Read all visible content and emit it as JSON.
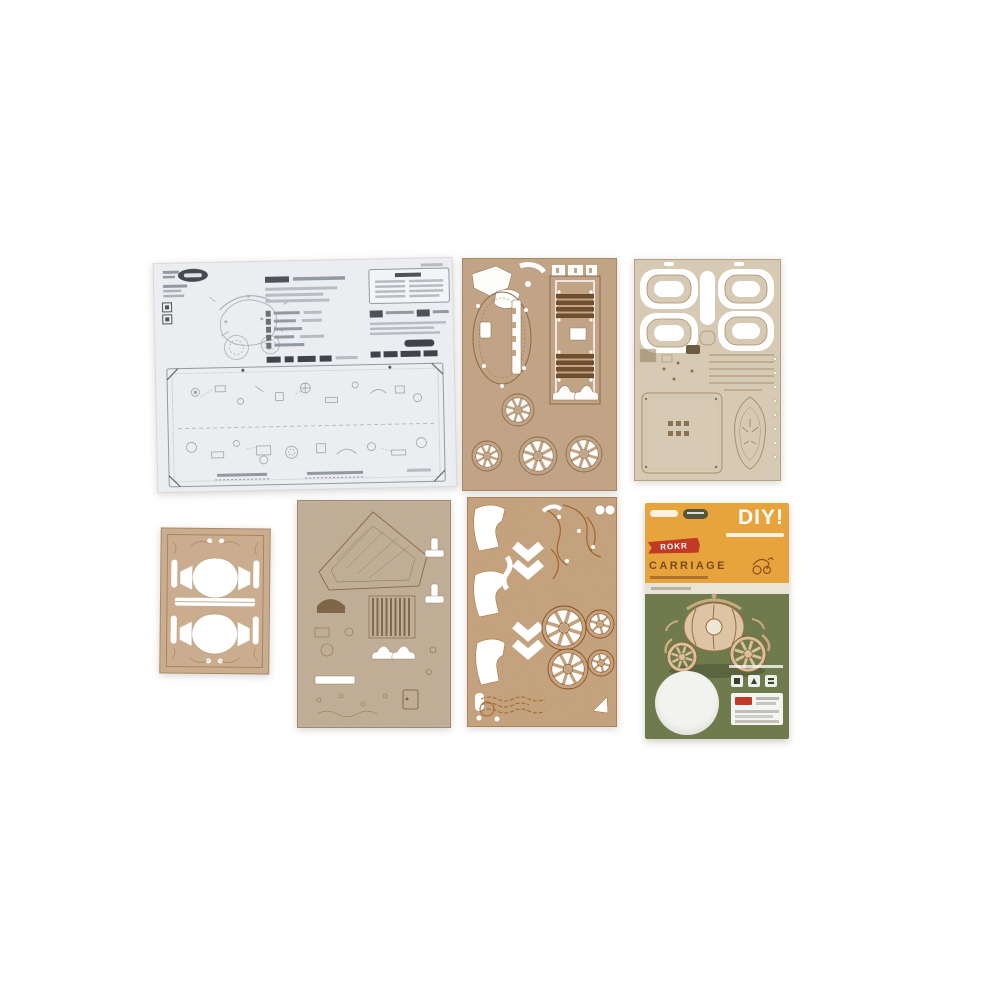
{
  "card": {
    "diy_label": "DIY!",
    "ribbon_label": "ROKR",
    "product_name": "CARRIAGE"
  },
  "colors": {
    "background": "#ffffff",
    "instruction_paper": "#ecedf0",
    "wood_sheet_top_middle": "#c1a385",
    "wood_sheet_top_right": "#d7cab4",
    "wood_sheet_small": "#c9ad8e",
    "wood_sheet_bottom_middle": "#c1af99",
    "wood_sheet_bottom_center": "#c4a27f",
    "card_header_orange": "#e8a43c",
    "card_body_green": "#6f7b4d",
    "card_ribbon_red": "#c13a28",
    "card_name_brown": "#7b4a1c",
    "card_divider": "#e8e5d6",
    "die_cut_circle": "#f2f2ef"
  }
}
